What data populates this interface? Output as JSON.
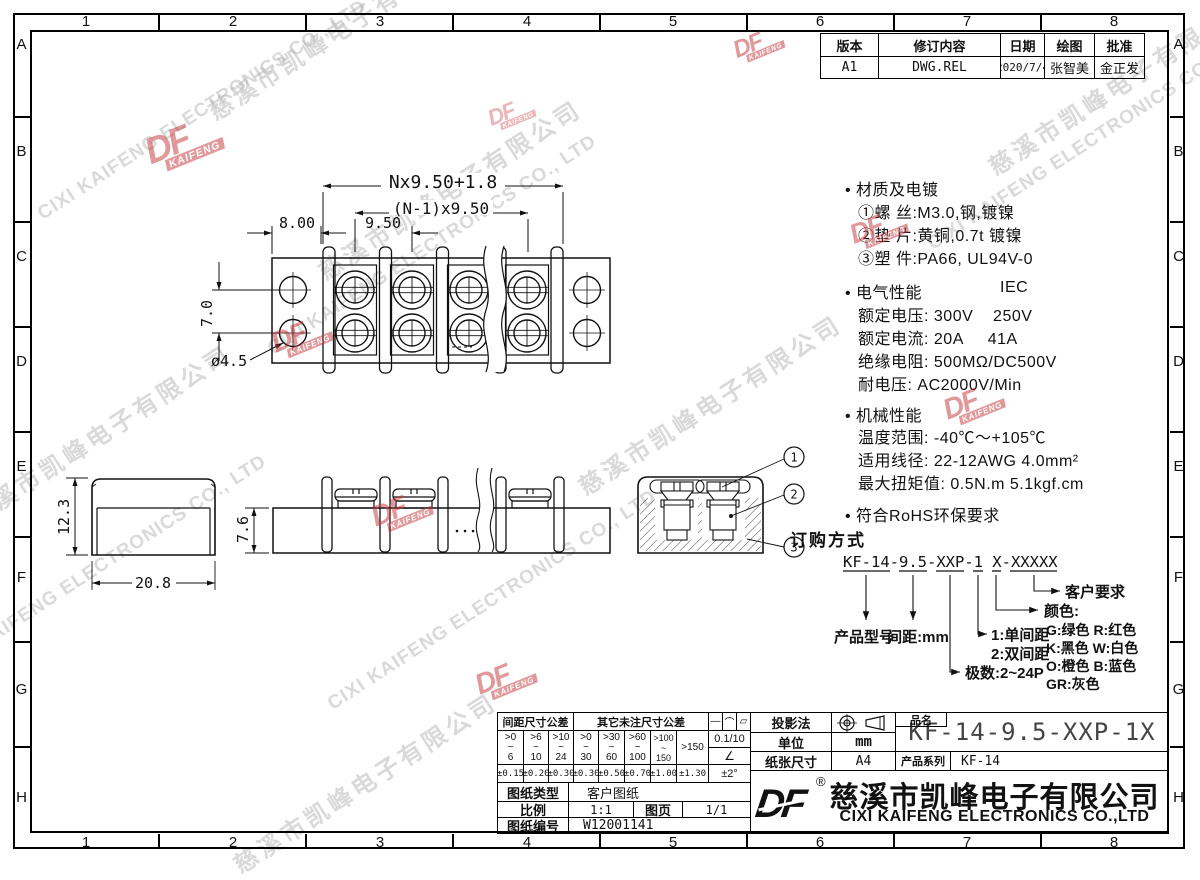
{
  "frame": {
    "cols": [
      "1",
      "2",
      "3",
      "4",
      "5",
      "6",
      "7",
      "8"
    ],
    "rows": [
      "A",
      "B",
      "C",
      "D",
      "E",
      "F",
      "G",
      "H"
    ]
  },
  "watermark": {
    "cn": "慈溪市凯峰电子有限公司",
    "en": "CIXI KAIFENG ELECTRONICS CO., LTD"
  },
  "stamp": {
    "logo": "DF",
    "sub": "KAIFENG"
  },
  "revision": {
    "headers": [
      "版本",
      "修订内容",
      "日期",
      "绘图",
      "批准"
    ],
    "row": [
      "A1",
      "DWG.REL",
      "2020/7/4",
      "张智美",
      "金正发"
    ]
  },
  "dims": {
    "total": "Nx9.50+1.8",
    "pitch_total": "(N-1)x9.50",
    "offset": "8.00",
    "pitch": "9.50",
    "row_gap": "7.0",
    "hole_dia": "ø4.5",
    "cover_height": "12.3",
    "cover_width": "20.8",
    "body_height": "7.6"
  },
  "balloons": {
    "b1": "1",
    "b2": "2",
    "b3": "3"
  },
  "specs": {
    "lines": [
      "• 材质及电镀",
      "①螺 丝:M3.0,钢,镀镍",
      "②垫 片:黄铜,0.7t 镀镍",
      "③塑 件:PA66, UL94V-0",
      "• 电气性能",
      "IEC",
      "额定电压: 300V    250V",
      "额定电流: 20A     41A",
      "绝缘电阻: 500MΩ/DC500V",
      "耐电压: AC2000V/Min",
      "• 机械性能",
      "温度范围: -40℃～+105℃",
      "适用线径: 22-12AWG 4.0mm²",
      "最大扭矩值: 0.5N.m 5.1kgf.cm",
      "• 符合RoHS环保要求"
    ]
  },
  "ordering": {
    "title": "订购方式",
    "code": "KF-14-9.5-XXP-1 X-XXXXX",
    "model_label": "产品型号",
    "pitch_label": "间距:mm",
    "poles_label": "极数:2~24P",
    "type1_label": "1:单间距",
    "type2_label": "2:双间距",
    "color_label": "颜色:",
    "color_row1": "G:绿色  R:红色",
    "color_row2": "K:黑色  W:白色",
    "color_row3": "O:橙色  B:蓝色",
    "color_row4": "GR:灰色",
    "customer_label": "客户要求"
  },
  "title_block": {
    "tol_pitch_header": "间距尺寸公差",
    "tol_other_header": "其它未注尺寸公差",
    "sym1": "—",
    "sym2": "⌒",
    "sym3": "▱",
    "tilde": "~",
    "ranges": [
      {
        "a": ">0",
        "b": "6"
      },
      {
        "a": ">6",
        "b": "10"
      },
      {
        "a": ">10",
        "b": "24"
      },
      {
        "a": ">0",
        "b": "30"
      },
      {
        "a": ">30",
        "b": "60"
      },
      {
        "a": ">60",
        "b": "100"
      },
      {
        "a": ">100",
        "b": "150"
      }
    ],
    "range_last": ">150",
    "tols": [
      "±0.15",
      "±0.20",
      "±0.30",
      "±0.30",
      "±0.50",
      "±0.70",
      "±1.00",
      "±1.30"
    ],
    "flat_tol": "0.1/10",
    "angle_sym": "∠",
    "angle_tol": "±2°",
    "doc_type_label": "图纸类型",
    "doc_type": "客户图纸",
    "scale_label": "比例",
    "scale": "1:1",
    "page_label": "图页",
    "page": "1/1",
    "doc_no_label": "图纸编号",
    "doc_no": "W12001141",
    "projection_label": "投影法",
    "unit_label": "单位",
    "unit": "mm",
    "paper_label": "纸张尺寸",
    "paper": "A4",
    "name_label": "品名",
    "name": "KF-14-9.5-XXP-1X",
    "series_label": "产品系列",
    "series": "KF-14"
  },
  "company": {
    "logo": "DF",
    "reg": "®",
    "cn": "慈溪市凯峰电子有限公司",
    "en": "CIXI KAIFENG ELECTRONICS CO.,LTD"
  }
}
